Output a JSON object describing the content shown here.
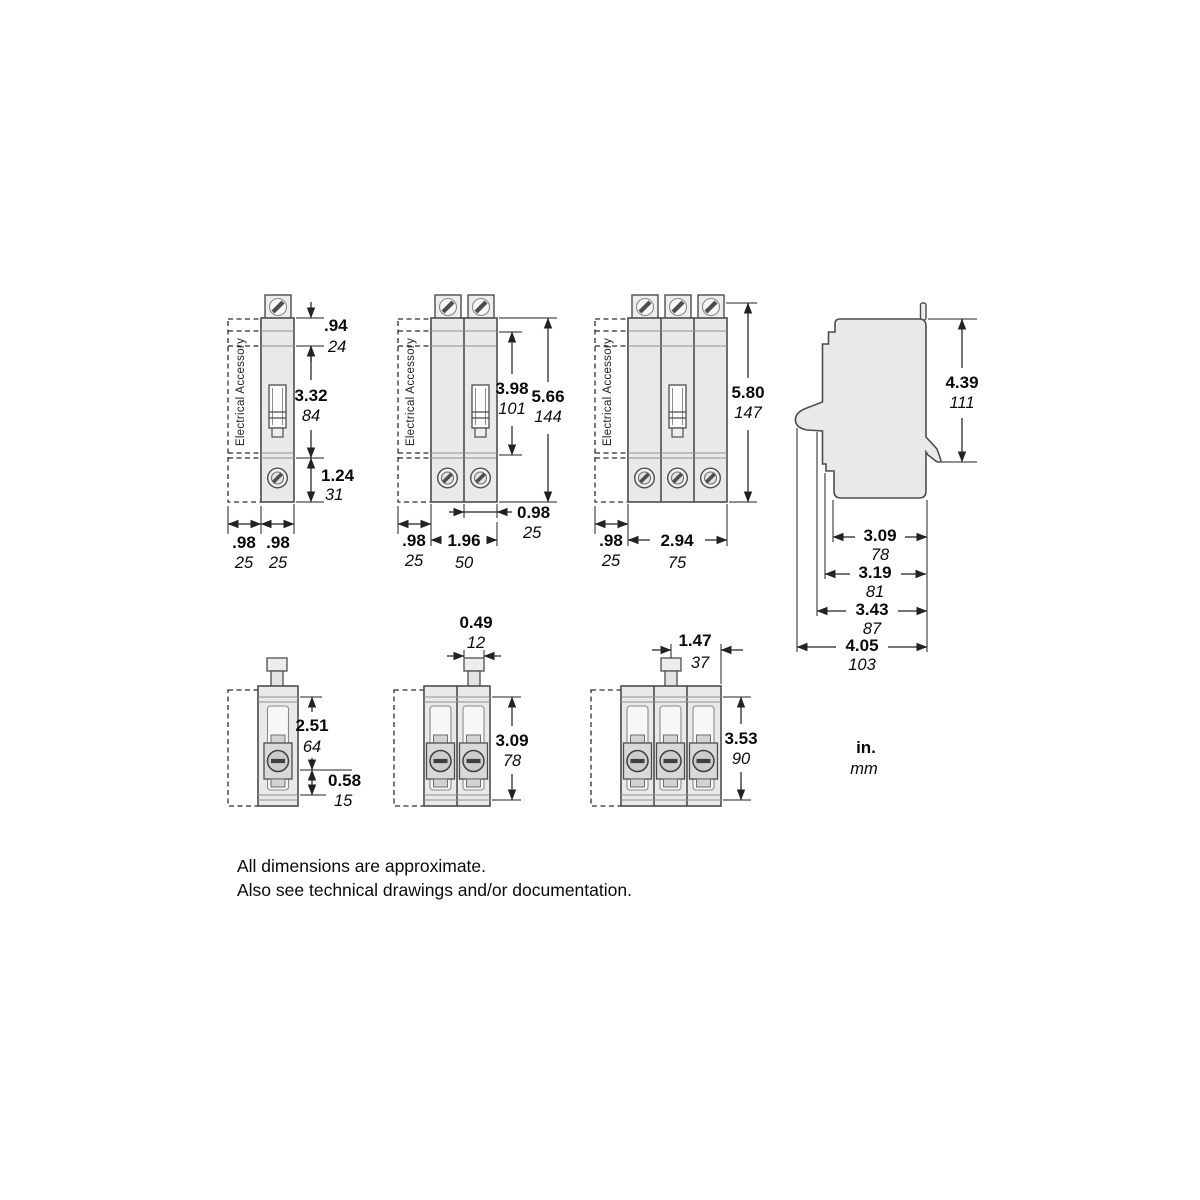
{
  "drawing": {
    "accessory_label": "Electrical Accessory",
    "legend": {
      "inches": "in.",
      "mm": "mm"
    },
    "notes": {
      "line1": "All dimensions are approximate.",
      "line2": "Also see technical drawings and/or documentation."
    },
    "front_1pole": {
      "top_height": {
        "in": ".94",
        "mm": "24"
      },
      "mid_height": {
        "in": "3.32",
        "mm": "84"
      },
      "bottom_height": {
        "in": "1.24",
        "mm": "31"
      },
      "accessory_widthریال": {
        "in": "",
        "mm": ""
      },
      "accessory_width": {
        "in": ".98",
        "mm": "25"
      },
      "pole_width": {
        "in": ".98",
        "mm": "25"
      }
    },
    "front_2pole": {
      "upper_height": {
        "in": "3.98",
        "mm": "101"
      },
      "total_height": {
        "in": "5.66",
        "mm": "144"
      },
      "pole_width": {
        "in": "0.98",
        "mm": "25"
      },
      "accessory_width": {
        "in": ".98",
        "mm": "25"
      },
      "total_width": {
        "in": "1.96",
        "mm": "50"
      }
    },
    "front_3pole": {
      "total_height": {
        "in": "5.80",
        "mm": "147"
      },
      "accessory_width": {
        "in": ".98",
        "mm": "25"
      },
      "total_width": {
        "in": "2.94",
        "mm": "75"
      }
    },
    "side": {
      "height": {
        "in": "4.39",
        "mm": "111"
      },
      "depth_1": {
        "in": "3.09",
        "mm": "78"
      },
      "depth_2": {
        "in": "3.19",
        "mm": "81"
      },
      "depth_3": {
        "in": "3.43",
        "mm": "87"
      },
      "depth_4": {
        "in": "4.05",
        "mm": "103"
      }
    },
    "top_1pole": {
      "upper_depth": {
        "in": "2.51",
        "mm": "64"
      },
      "lug_depth": {
        "in": "0.58",
        "mm": "15"
      }
    },
    "top_2pole": {
      "handle_width": {
        "in": "0.49",
        "mm": "12"
      },
      "body_depth": {
        "in": "3.09",
        "mm": "78"
      }
    },
    "top_3pole": {
      "handle_offset": {
        "in": "1.47",
        "mm": "37"
      },
      "body_depth": {
        "in": "3.53",
        "mm": "90"
      }
    }
  }
}
